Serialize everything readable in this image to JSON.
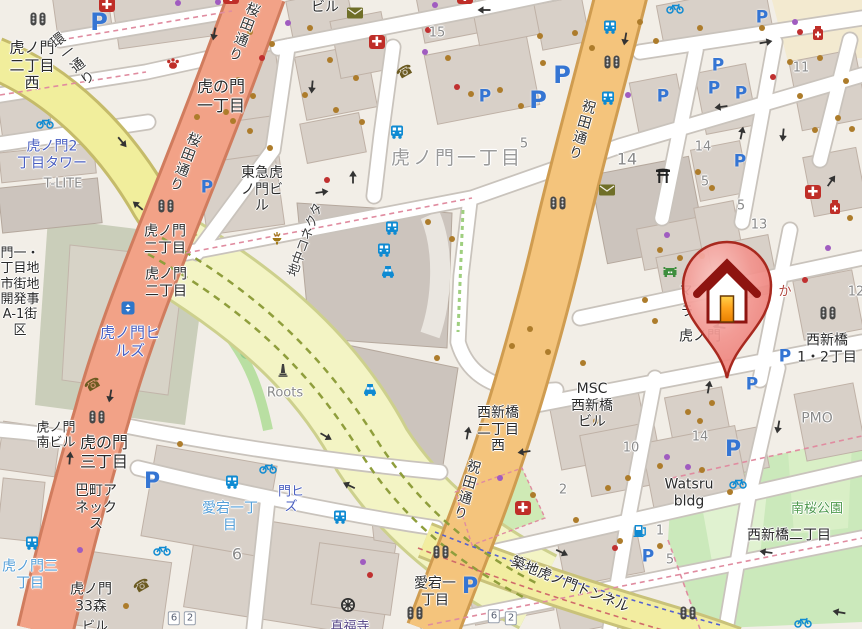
{
  "colors": {
    "background": "#f2eee7",
    "building": "#d8d0c8",
    "building_dark": "#ccc4bd",
    "road_trunk": "#f2a287",
    "road_primary": "#f4c47c",
    "road_secondary": "#f1ee9c",
    "road_tunnel": "#f3f4c4",
    "park": "#cbe9bb",
    "parking_blue": "#3575d3",
    "transport_blue": "#0e8ad2",
    "poi_red": "#bf2e28",
    "dot_brown": "#ad7c2b",
    "dot_purple": "#a05cc0",
    "dot_red": "#c03030",
    "label_blue": "#4a5fc0",
    "stop_blue": "#57a0d8",
    "park_text_green": "#4e9a4e",
    "marker_pink": "#f2928c"
  },
  "marker": {
    "name": "house-marker",
    "shape": "balloon-with-house",
    "x": 727,
    "tip_y": 378
  },
  "place_labels": [
    {
      "text": "虎ノ門\n二丁目\n西",
      "x": 32,
      "y": 66,
      "size": 15,
      "color": "#2b2b2b"
    },
    {
      "text": "環一通り",
      "x": 72,
      "y": 60,
      "size": 14,
      "color": "#333333",
      "vertical": true,
      "rot": -38
    },
    {
      "text": "桜田通り",
      "x": 243,
      "y": 32,
      "size": 14,
      "color": "#333333",
      "vertical": true,
      "rot": 21
    },
    {
      "text": "桜田通り",
      "x": 184,
      "y": 162,
      "size": 14,
      "color": "#333333",
      "vertical": true,
      "rot": 21
    },
    {
      "text": "虎の門\n一丁目",
      "x": 221,
      "y": 97,
      "size": 16,
      "color": "#2b2b2b"
    },
    {
      "text": "虎ノ門2\n丁目タワー",
      "x": 52,
      "y": 155,
      "size": 14,
      "color": "#4a5fc0"
    },
    {
      "text": "T-LITE",
      "x": 63,
      "y": 184,
      "size": 13,
      "color": "#8a8a8a"
    },
    {
      "text": "東急虎\nノ門ビ\nル",
      "x": 262,
      "y": 190,
      "size": 14,
      "color": "#2b2b2b"
    },
    {
      "text": "地中コネクタ",
      "x": 306,
      "y": 240,
      "size": 13,
      "color": "#3f3f3f",
      "rot": -70
    },
    {
      "text": "虎ノ門一丁目",
      "x": 457,
      "y": 158,
      "size": 19,
      "color": "#9a9a9a",
      "spacing": 3
    },
    {
      "text": "虎ノ門\n二丁目",
      "x": 165,
      "y": 240,
      "size": 14,
      "color": "#2b2b2b"
    },
    {
      "text": "虎ノ門\n二丁目",
      "x": 166,
      "y": 283,
      "size": 14,
      "color": "#2b2b2b"
    },
    {
      "text": "虎ノ門ヒ\nルズ",
      "x": 130,
      "y": 342,
      "size": 15,
      "color": "#4a5fc0"
    },
    {
      "text": "門一・\n丁目地\n市街地\n開発事\nA-1街\n区",
      "x": 20,
      "y": 292,
      "size": 13,
      "color": "#2b2b2b"
    },
    {
      "text": "Roots",
      "x": 285,
      "y": 393,
      "size": 13,
      "color": "#8a8a8a"
    },
    {
      "text": "MSC\n西新橋\nビル",
      "x": 592,
      "y": 406,
      "size": 14,
      "color": "#2b2b2b"
    },
    {
      "text": "西新橋\n二丁目\n西",
      "x": 498,
      "y": 430,
      "size": 14,
      "color": "#2b2b2b"
    },
    {
      "text": "祝田通り",
      "x": 581,
      "y": 130,
      "size": 14,
      "color": "#333333",
      "vertical": true,
      "rot": 16
    },
    {
      "text": "祝田通り",
      "x": 466,
      "y": 490,
      "size": 14,
      "color": "#333333",
      "vertical": true,
      "rot": 16
    },
    {
      "text": "マ",
      "x": 686,
      "y": 291,
      "size": 13,
      "color": "#2b2b2b"
    },
    {
      "text": "ラ",
      "x": 687,
      "y": 312,
      "size": 13,
      "color": "#2b2b2b"
    },
    {
      "text": "虎ノ門",
      "x": 700,
      "y": 337,
      "size": 14,
      "color": "#2b2b2b"
    },
    {
      "text": "か",
      "x": 785,
      "y": 292,
      "size": 13,
      "color": "#b0483f"
    },
    {
      "text": "西新橋\n1・2丁目",
      "x": 827,
      "y": 349,
      "size": 14,
      "color": "#2b2b2b"
    },
    {
      "text": "PMO",
      "x": 817,
      "y": 419,
      "size": 14,
      "color": "#8a8a8a"
    },
    {
      "text": "Watsru\nbldg",
      "x": 689,
      "y": 493,
      "size": 14,
      "color": "#2b2b2b"
    },
    {
      "text": "南桜公園",
      "x": 817,
      "y": 509,
      "size": 13,
      "color": "#4e9a4e"
    },
    {
      "text": "西新橋二丁目",
      "x": 789,
      "y": 536,
      "size": 14,
      "color": "#2b2b2b"
    },
    {
      "text": "築地虎ノ門トンネル",
      "x": 570,
      "y": 585,
      "size": 14,
      "color": "#2b2b2b",
      "rot": 22
    },
    {
      "text": "愛宕一\n丁目",
      "x": 435,
      "y": 592,
      "size": 14,
      "color": "#2b2b2b"
    },
    {
      "text": "愛宕一丁\n目",
      "x": 230,
      "y": 517,
      "size": 14,
      "color": "#57a0d8"
    },
    {
      "text": "虎ノ門三\n丁目",
      "x": 30,
      "y": 575,
      "size": 14,
      "color": "#57a0d8"
    },
    {
      "text": "虎ノ門\n南ビル",
      "x": 56,
      "y": 436,
      "size": 13,
      "color": "#2b2b2b"
    },
    {
      "text": "虎の門\n三丁目",
      "x": 104,
      "y": 453,
      "size": 16,
      "color": "#2b2b2b"
    },
    {
      "text": "巴町ア\nネック\nス",
      "x": 96,
      "y": 508,
      "size": 14,
      "color": "#2b2b2b"
    },
    {
      "text": "虎ノ門\n33森",
      "x": 91,
      "y": 598,
      "size": 14,
      "color": "#2b2b2b"
    },
    {
      "text": "ビル",
      "x": 325,
      "y": 8,
      "size": 14,
      "color": "#2b2b2b"
    },
    {
      "text": "門ヒ\nズ",
      "x": 291,
      "y": 500,
      "size": 13,
      "color": "#4a5fc0"
    },
    {
      "text": "真福寺",
      "x": 350,
      "y": 627,
      "size": 13,
      "color": "#5a4a8a"
    },
    {
      "text": "ビル",
      "x": 95,
      "y": 627,
      "size": 13,
      "color": "#2b2b2b"
    }
  ],
  "numbers": [
    {
      "t": "15",
      "x": 437,
      "y": 33
    },
    {
      "t": "5",
      "x": 524,
      "y": 144
    },
    {
      "t": "14",
      "x": 627,
      "y": 160,
      "big": true
    },
    {
      "t": "14",
      "x": 703,
      "y": 147
    },
    {
      "t": "5",
      "x": 705,
      "y": 182
    },
    {
      "t": "5",
      "x": 741,
      "y": 206
    },
    {
      "t": "11",
      "x": 801,
      "y": 68
    },
    {
      "t": "13",
      "x": 759,
      "y": 225
    },
    {
      "t": "12",
      "x": 856,
      "y": 292
    },
    {
      "t": "2",
      "x": 563,
      "y": 490
    },
    {
      "t": "10",
      "x": 631,
      "y": 448
    },
    {
      "t": "14",
      "x": 700,
      "y": 437
    },
    {
      "t": "1",
      "x": 660,
      "y": 531
    },
    {
      "t": "5",
      "x": 670,
      "y": 560
    },
    {
      "t": "6",
      "x": 237,
      "y": 555,
      "big": true
    }
  ],
  "house_numbers": [
    {
      "t": "6",
      "x": 174,
      "y": 618
    },
    {
      "t": "2",
      "x": 190,
      "y": 618
    },
    {
      "t": "6",
      "x": 494,
      "y": 616
    },
    {
      "t": "2",
      "x": 511,
      "y": 618
    }
  ],
  "icons": [
    {
      "t": "parking",
      "x": 99,
      "y": 22,
      "s": 24
    },
    {
      "t": "parking",
      "x": 207,
      "y": 188
    },
    {
      "t": "parking",
      "x": 485,
      "y": 97
    },
    {
      "t": "parking",
      "x": 538,
      "y": 100,
      "s": 24
    },
    {
      "t": "parking",
      "x": 562,
      "y": 75,
      "s": 24
    },
    {
      "t": "parking",
      "x": 762,
      "y": 18
    },
    {
      "t": "parking",
      "x": 718,
      "y": 66
    },
    {
      "t": "parking",
      "x": 714,
      "y": 89
    },
    {
      "t": "parking",
      "x": 741,
      "y": 94
    },
    {
      "t": "parking",
      "x": 663,
      "y": 97
    },
    {
      "t": "parking",
      "x": 740,
      "y": 162
    },
    {
      "t": "parking",
      "x": 785,
      "y": 357
    },
    {
      "t": "parking",
      "x": 752,
      "y": 385
    },
    {
      "t": "parking",
      "x": 152,
      "y": 482,
      "s": 22
    },
    {
      "t": "parking",
      "x": 470,
      "y": 587,
      "s": 22
    },
    {
      "t": "parking",
      "x": 733,
      "y": 450,
      "s": 22
    },
    {
      "t": "parking",
      "x": 648,
      "y": 557
    },
    {
      "t": "hospital",
      "x": 107,
      "y": 5
    },
    {
      "t": "hospital",
      "x": 377,
      "y": 42
    },
    {
      "t": "hospital",
      "x": 813,
      "y": 192
    },
    {
      "t": "hospital",
      "x": 523,
      "y": 508
    },
    {
      "t": "hospital",
      "x": 231,
      "y": -3
    },
    {
      "t": "hospital",
      "x": 465,
      "y": -3
    },
    {
      "t": "pharmacy",
      "x": 818,
      "y": 33
    },
    {
      "t": "pharmacy",
      "x": 835,
      "y": 207
    },
    {
      "t": "veterinary",
      "x": 173,
      "y": 63
    },
    {
      "t": "mail",
      "x": 355,
      "y": 13
    },
    {
      "t": "mail",
      "x": 607,
      "y": 190
    },
    {
      "t": "torii",
      "x": 663,
      "y": 175
    },
    {
      "t": "phone",
      "x": 405,
      "y": 72
    },
    {
      "t": "phone",
      "x": 93,
      "y": 385
    },
    {
      "t": "phone",
      "x": 142,
      "y": 586
    },
    {
      "t": "bus",
      "x": 610,
      "y": 27
    },
    {
      "t": "bus",
      "x": 608,
      "y": 98
    },
    {
      "t": "bus",
      "x": 397,
      "y": 132
    },
    {
      "t": "bus",
      "x": 392,
      "y": 228
    },
    {
      "t": "bus",
      "x": 384,
      "y": 250
    },
    {
      "t": "bus",
      "x": 232,
      "y": 482
    },
    {
      "t": "bus",
      "x": 340,
      "y": 517
    },
    {
      "t": "bus",
      "x": 32,
      "y": 543
    },
    {
      "t": "taxi",
      "x": 388,
      "y": 272
    },
    {
      "t": "taxi",
      "x": 370,
      "y": 390
    },
    {
      "t": "bicycle",
      "x": 45,
      "y": 123
    },
    {
      "t": "bicycle",
      "x": 675,
      "y": 8
    },
    {
      "t": "bicycle",
      "x": 268,
      "y": 468
    },
    {
      "t": "bicycle",
      "x": 162,
      "y": 550
    },
    {
      "t": "bicycle",
      "x": 738,
      "y": 483
    },
    {
      "t": "bicycle",
      "x": 803,
      "y": 622
    },
    {
      "t": "signal",
      "x": 38,
      "y": 19
    },
    {
      "t": "signal",
      "x": 166,
      "y": 206
    },
    {
      "t": "signal",
      "x": 612,
      "y": 62
    },
    {
      "t": "signal",
      "x": 558,
      "y": 203
    },
    {
      "t": "signal",
      "x": 441,
      "y": 552
    },
    {
      "t": "signal",
      "x": 415,
      "y": 613
    },
    {
      "t": "signal",
      "x": 828,
      "y": 313
    },
    {
      "t": "signal",
      "x": 97,
      "y": 417
    },
    {
      "t": "signal",
      "x": 688,
      "y": 613
    },
    {
      "t": "elevator",
      "x": 128,
      "y": 308
    },
    {
      "t": "fountain",
      "x": 277,
      "y": 238
    },
    {
      "t": "monument",
      "x": 283,
      "y": 370
    },
    {
      "t": "temple",
      "x": 348,
      "y": 605
    },
    {
      "t": "arcade",
      "x": 670,
      "y": 272
    },
    {
      "t": "fuel",
      "x": 640,
      "y": 530
    }
  ],
  "arrows": [
    [
      483,
      10,
      180
    ],
    [
      312,
      88,
      95
    ],
    [
      323,
      192,
      -8
    ],
    [
      353,
      176,
      -90
    ],
    [
      625,
      40,
      100
    ],
    [
      767,
      42,
      -10
    ],
    [
      720,
      107,
      172
    ],
    [
      742,
      132,
      -78
    ],
    [
      783,
      136,
      95
    ],
    [
      832,
      180,
      -55
    ],
    [
      718,
      327,
      188
    ],
    [
      709,
      386,
      -80
    ],
    [
      778,
      428,
      100
    ],
    [
      765,
      552,
      188
    ],
    [
      468,
      432,
      -80
    ],
    [
      523,
      452,
      172
    ],
    [
      563,
      553,
      25
    ],
    [
      70,
      457,
      -85
    ],
    [
      110,
      397,
      100
    ],
    [
      137,
      205,
      -140
    ],
    [
      123,
      143,
      50
    ],
    [
      327,
      437,
      30
    ],
    [
      348,
      485,
      205
    ],
    [
      838,
      612,
      190
    ],
    [
      214,
      35,
      100
    ]
  ],
  "dots": {
    "brown": [
      [
        250,
        32
      ],
      [
        272,
        44
      ],
      [
        238,
        80
      ],
      [
        253,
        96
      ],
      [
        226,
        112
      ],
      [
        250,
        131
      ],
      [
        270,
        148
      ],
      [
        197,
        117
      ],
      [
        233,
        121
      ],
      [
        310,
        28
      ],
      [
        330,
        60
      ],
      [
        356,
        78
      ],
      [
        305,
        95
      ],
      [
        336,
        110
      ],
      [
        362,
        122
      ],
      [
        448,
        58
      ],
      [
        471,
        94
      ],
      [
        500,
        90
      ],
      [
        521,
        106
      ],
      [
        543,
        63
      ],
      [
        540,
        36
      ],
      [
        575,
        33
      ],
      [
        592,
        48
      ],
      [
        640,
        22
      ],
      [
        656,
        41
      ],
      [
        700,
        28
      ],
      [
        762,
        28
      ],
      [
        820,
        58
      ],
      [
        846,
        81
      ],
      [
        838,
        118
      ],
      [
        852,
        129
      ],
      [
        790,
        62
      ],
      [
        698,
        172
      ],
      [
        712,
        188
      ],
      [
        660,
        250
      ],
      [
        680,
        258
      ],
      [
        702,
        256
      ],
      [
        645,
        300
      ],
      [
        655,
        321
      ],
      [
        700,
        421
      ],
      [
        688,
        412
      ],
      [
        712,
        403
      ],
      [
        660,
        466
      ],
      [
        702,
        470
      ],
      [
        730,
        492
      ],
      [
        608,
        488
      ],
      [
        628,
        478
      ],
      [
        596,
        421
      ],
      [
        548,
        352
      ],
      [
        530,
        329
      ],
      [
        512,
        346
      ],
      [
        428,
        222
      ],
      [
        452,
        239
      ],
      [
        576,
        520
      ],
      [
        620,
        541
      ],
      [
        660,
        546
      ],
      [
        850,
        218
      ],
      [
        815,
        130
      ],
      [
        800,
        96
      ],
      [
        180,
        444
      ],
      [
        126,
        606
      ],
      [
        437,
        358
      ],
      [
        583,
        363
      ],
      [
        533,
        495
      ]
    ],
    "purple": [
      [
        178,
        3
      ],
      [
        218,
        2
      ],
      [
        288,
        23
      ],
      [
        425,
        52
      ],
      [
        435,
        5
      ],
      [
        628,
        95
      ],
      [
        795,
        22
      ],
      [
        828,
        248
      ],
      [
        667,
        235
      ],
      [
        398,
        133
      ],
      [
        80,
        550
      ],
      [
        363,
        562
      ],
      [
        667,
        457
      ],
      [
        688,
        467
      ],
      [
        500,
        478
      ]
    ],
    "red": [
      [
        428,
        30
      ],
      [
        457,
        87
      ],
      [
        262,
        58
      ],
      [
        327,
        180
      ],
      [
        773,
        77
      ],
      [
        800,
        32
      ],
      [
        370,
        575
      ],
      [
        615,
        548
      ],
      [
        805,
        280
      ]
    ]
  }
}
